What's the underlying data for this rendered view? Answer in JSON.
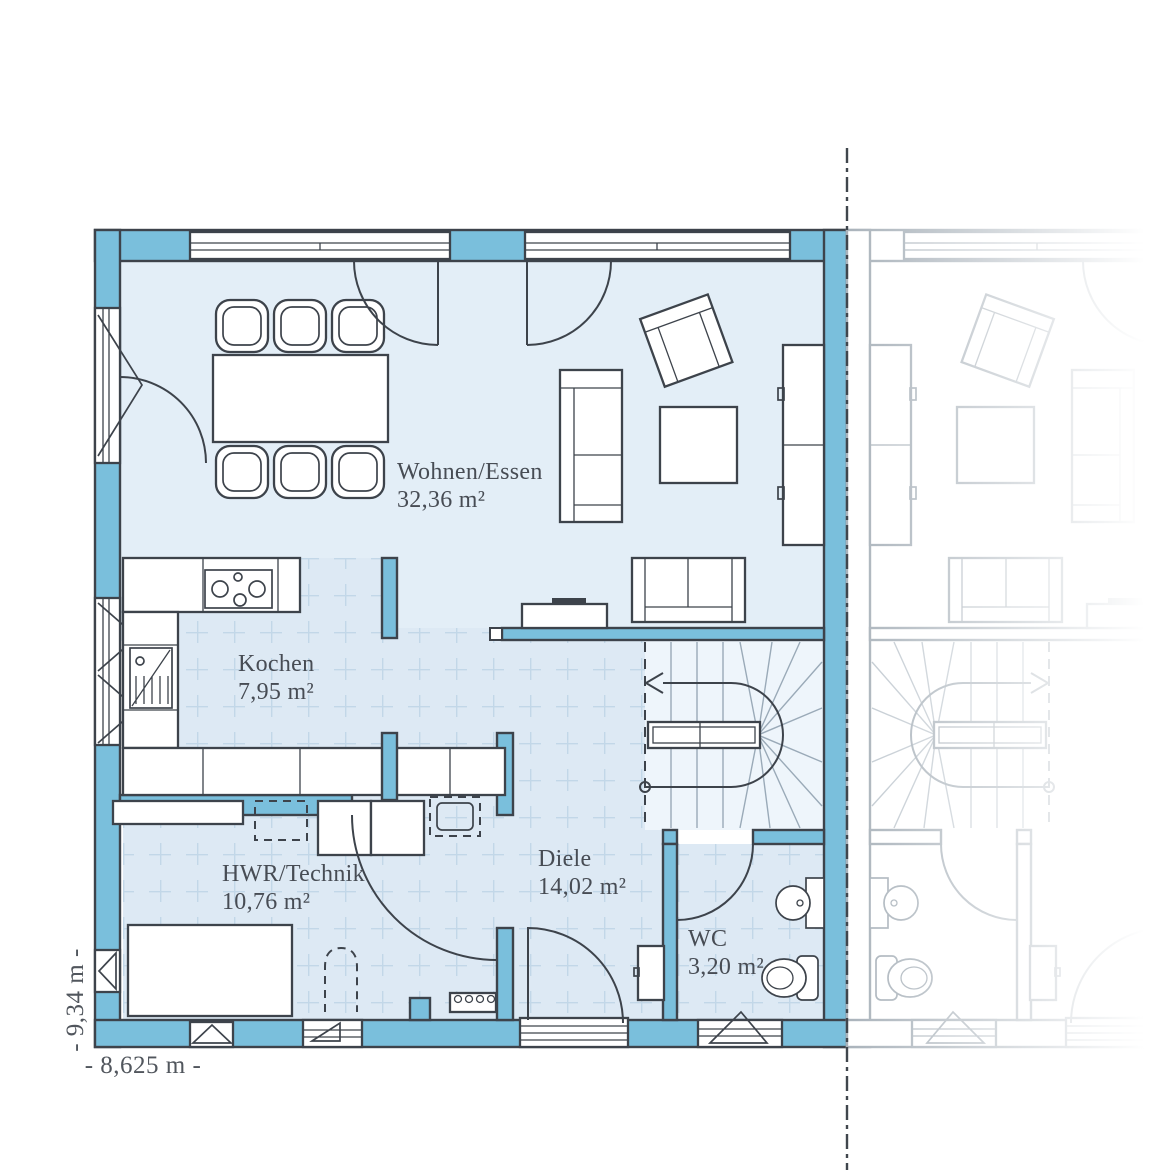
{
  "plan": {
    "type": "floor-plan",
    "rooms": [
      {
        "label": "Wohnen/Essen",
        "area": "32,36 m²"
      },
      {
        "label": "Kochen",
        "area": "7,95 m²"
      },
      {
        "label": "HWR/Technik",
        "area": "10,76 m²"
      },
      {
        "label": "Diele",
        "area": "14,02 m²"
      },
      {
        "label": "WC",
        "area": "3,20 m²"
      }
    ],
    "dimensions": {
      "width_label": "- 8,625 m -",
      "height_label": "- 9,34 m -"
    },
    "colors": {
      "wall": "#7abfdc",
      "outline": "#3d434b",
      "floor": "#e3eef7",
      "tile_floor": "#dde9f4",
      "stair_floor": "#eef5fb",
      "label_text": "#474c54",
      "ghost": "#aab3bb"
    }
  }
}
